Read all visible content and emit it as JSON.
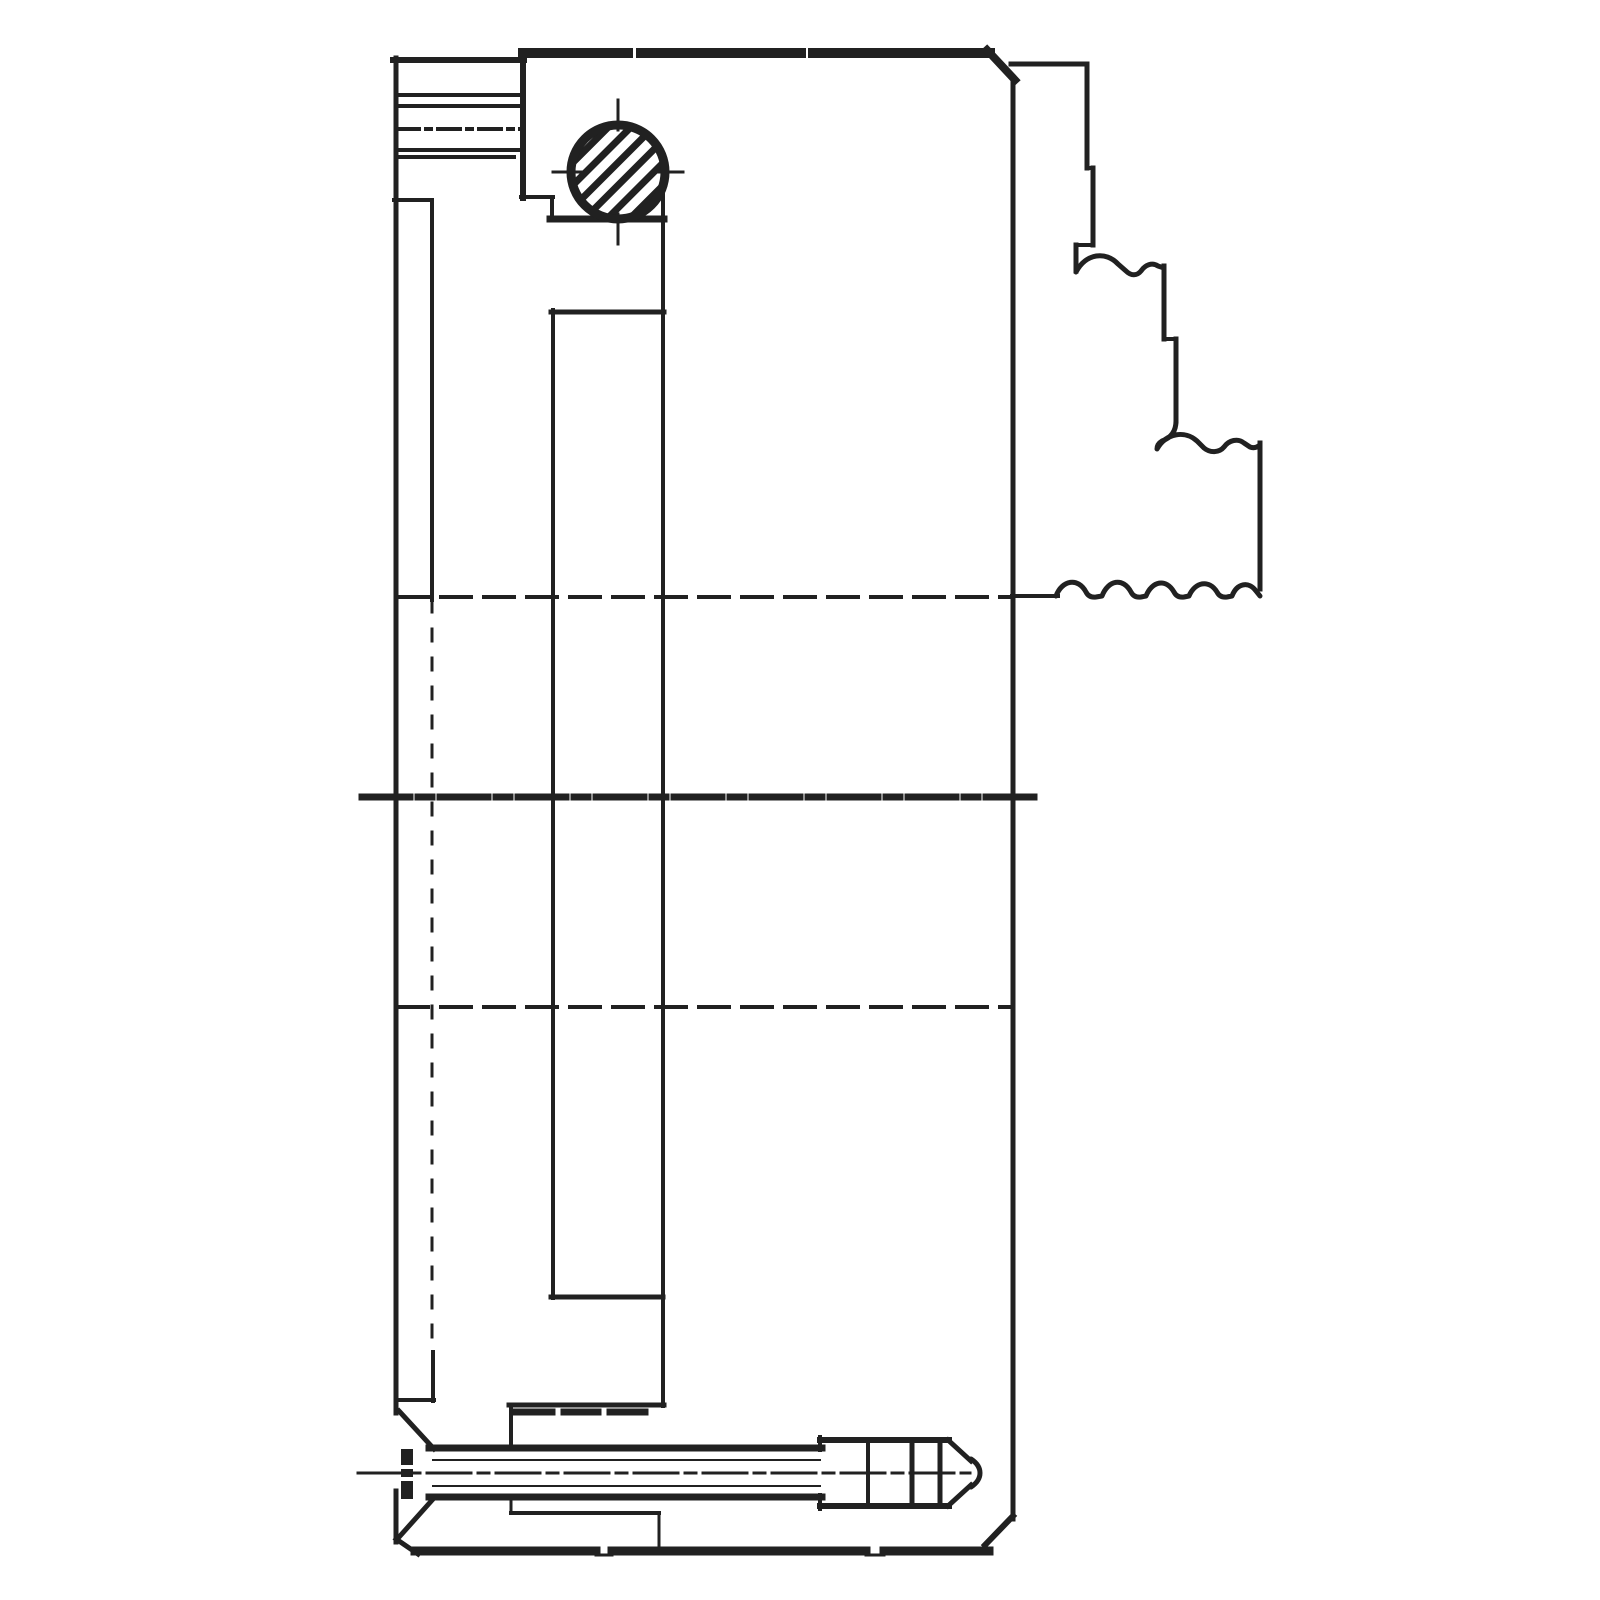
{
  "meta": {
    "description": "Scanned black-and-white engineering cross-section drawing of a lathe chuck body with stepped reversible jaw, hatched bevel-pinion circle and countersunk screw",
    "background_color": "#ffffff",
    "ink_color": "#212121"
  },
  "canvas": {
    "width": 1600,
    "height": 1600
  },
  "drawing": {
    "stroke_color": "#212121",
    "hatch": {
      "spacing": 16,
      "line_width": 7,
      "angle_deg": -45
    },
    "groups": [
      {
        "name": "body-outline",
        "lines": [
          [
            396,
            58,
            396,
            1413,
            5
          ],
          [
            393,
            60,
            524,
            60,
            6
          ],
          [
            523,
            53,
            628,
            53,
            10
          ],
          [
            641,
            53,
            801,
            53,
            10
          ],
          [
            813,
            53,
            990,
            53,
            10
          ],
          [
            987,
            50,
            1015,
            80,
            8
          ],
          [
            1013,
            77,
            1013,
            1519,
            5
          ],
          [
            1013,
            1516,
            985,
            1545,
            6
          ],
          [
            415,
            1551,
            596,
            1551,
            9
          ],
          [
            612,
            1551,
            866,
            1551,
            9
          ],
          [
            884,
            1551,
            989,
            1551,
            9
          ],
          [
            596,
            1555,
            612,
            1555,
            3
          ],
          [
            866,
            1555,
            884,
            1555,
            3
          ],
          [
            396,
            1539,
            418,
            1554,
            5
          ],
          [
            396,
            1491,
            396,
            1542,
            5
          ],
          [
            397,
            95,
            523,
            95,
            4
          ],
          [
            397,
            106,
            523,
            106,
            4
          ],
          [
            397,
            150,
            521,
            150,
            4
          ],
          [
            397,
            157,
            514,
            157,
            4
          ],
          [
            394,
            200,
            432,
            200,
            4
          ],
          [
            432,
            200,
            432,
            600,
            4
          ],
          [
            433,
            1352,
            433,
            1401,
            4
          ],
          [
            396,
            1400,
            434,
            1400,
            4
          ],
          [
            523,
            58,
            523,
            198,
            6
          ],
          [
            521,
            197,
            553,
            197,
            4
          ],
          [
            552,
            197,
            552,
            219,
            4
          ],
          [
            550,
            219,
            664,
            219,
            7
          ],
          [
            553,
            310,
            553,
            1298,
            4
          ],
          [
            551,
            312,
            664,
            312,
            5
          ],
          [
            663,
            192,
            663,
            1406,
            4
          ],
          [
            551,
            1297,
            663,
            1297,
            5
          ],
          [
            509,
            1405,
            664,
            1405,
            5
          ],
          [
            511,
            1405,
            511,
            1446,
            4
          ],
          [
            516,
            1412,
            552,
            1412,
            7
          ],
          [
            564,
            1412,
            598,
            1412,
            7
          ],
          [
            610,
            1412,
            645,
            1412,
            7
          ]
        ]
      },
      {
        "name": "jaw-outline",
        "lines": [
          [
            1011,
            64,
            1087,
            64,
            5
          ],
          [
            1087,
            64,
            1087,
            168,
            5
          ],
          [
            1087,
            168,
            1093,
            168,
            4
          ],
          [
            1093,
            168,
            1093,
            245,
            5
          ],
          [
            1093,
            245,
            1076,
            245,
            4
          ],
          [
            1076,
            245,
            1076,
            271,
            5
          ],
          [
            1164,
            266,
            1164,
            339,
            5
          ],
          [
            1164,
            339,
            1176,
            339,
            4
          ],
          [
            1176,
            339,
            1176,
            421,
            5
          ],
          [
            1260,
            443,
            1260,
            589,
            5
          ],
          [
            1012,
            596,
            1058,
            596,
            4
          ]
        ],
        "paths": [
          {
            "d": "M1076,272 C1086,253 1106,251 1118,264 L1126,271 C1131,276 1137,276 1141,271 C1145,265 1152,262 1158,266 L1164,268",
            "w": 5
          },
          {
            "d": "M1176,421 Q1176,436 1162,441 Q1157,444 1157,449 C1166,433 1185,430 1197,441 L1204,448 C1210,453 1219,453 1224,447 C1229,440 1238,438 1244,443 L1250,447 Q1255,449 1260,445",
            "w": 5
          },
          {
            "d": "M1056,596 C1062,580 1078,577 1086,592 Q1089,598 1096,597 L1102,596 C1108,580 1123,577 1131,592 Q1134,598 1141,597 L1146,596 C1152,581 1166,578 1174,592 Q1177,598 1184,597 L1189,596 C1195,582 1209,579 1217,592 Q1220,598 1227,597 L1232,596 C1237,583 1249,581 1256,591 L1260,596",
            "w": 5
          }
        ]
      },
      {
        "name": "screw-section",
        "lines": [
          [
            429,
            1448,
            822,
            1448,
            7
          ],
          [
            429,
            1497,
            822,
            1497,
            7
          ],
          [
            433,
            1460,
            820,
            1460,
            2
          ],
          [
            433,
            1486,
            820,
            1486,
            2
          ],
          [
            820,
            1440,
            949,
            1440,
            6
          ],
          [
            820,
            1506,
            949,
            1506,
            6
          ],
          [
            820,
            1437,
            820,
            1450,
            4
          ],
          [
            820,
            1495,
            820,
            1509,
            4
          ],
          [
            868,
            1441,
            868,
            1505,
            4
          ],
          [
            912,
            1441,
            912,
            1505,
            5
          ],
          [
            940,
            1441,
            940,
            1505,
            5
          ],
          [
            948,
            1440,
            971,
            1461,
            5
          ],
          [
            948,
            1506,
            971,
            1485,
            5
          ],
          [
            399,
            1411,
            434,
            1449,
            5
          ],
          [
            400,
            1536,
            434,
            1498,
            5
          ],
          [
            511,
            1499,
            511,
            1513,
            3
          ],
          [
            511,
            1513,
            659,
            1513,
            4
          ],
          [
            659,
            1513,
            659,
            1549,
            3
          ],
          [
            399,
            1467,
            416,
            1467,
            4,
            null,
            "white"
          ],
          [
            399,
            1479,
            416,
            1479,
            4,
            null,
            "white"
          ]
        ],
        "rects": [
          {
            "x": 401,
            "y": 1449,
            "w": 12,
            "h": 50
          }
        ],
        "paths": [
          {
            "d": "M971,1459 Q980,1465 980,1473 Q980,1481 971,1487",
            "w": 5
          }
        ],
        "order": [
          "rects",
          "lines",
          "paths"
        ]
      },
      {
        "name": "hidden-lines",
        "lines": [
          [
            398,
            597,
            1011,
            597,
            4,
            "30 13"
          ],
          [
            398,
            1007,
            1011,
            1007,
            4,
            "30 13"
          ],
          [
            432,
            600,
            432,
            1352,
            3,
            "12 17"
          ]
        ]
      },
      {
        "name": "centerlines",
        "lines": [
          [
            397,
            129,
            522,
            129,
            4,
            "22 7 5 7"
          ],
          [
            362,
            797,
            1037,
            797,
            7,
            "48 8 14 8"
          ],
          [
            358,
            1473,
            970,
            1473,
            3,
            "44 7 11 7"
          ]
        ]
      },
      {
        "name": "pinion-gear-section",
        "circles": [
          {
            "cx": 618,
            "cy": 172,
            "r": 47,
            "w": 9,
            "hatch": true
          }
        ],
        "lines": [
          [
            618,
            100,
            618,
            130,
            3
          ],
          [
            618,
            214,
            618,
            244,
            3
          ],
          [
            553,
            172,
            583,
            172,
            3
          ],
          [
            653,
            172,
            683,
            172,
            3
          ]
        ]
      }
    ]
  }
}
